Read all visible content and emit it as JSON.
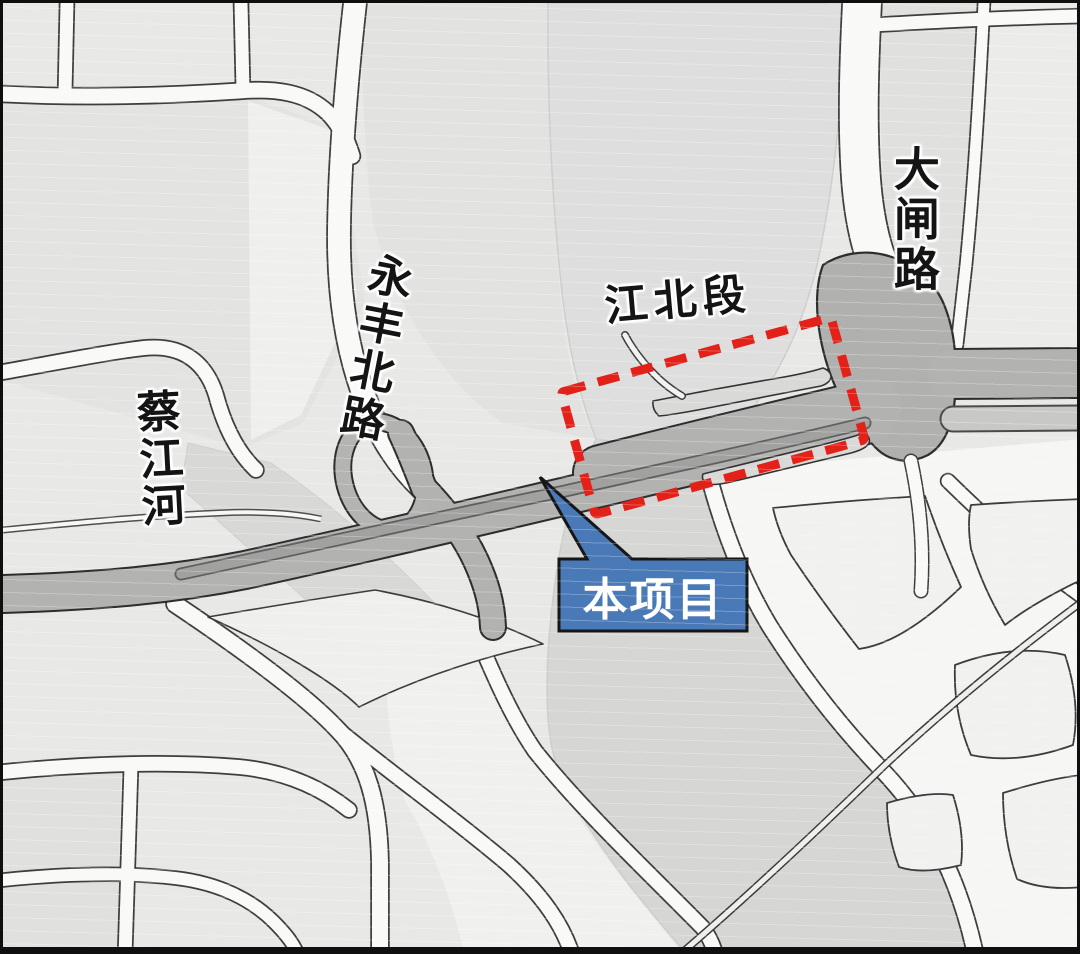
{
  "map": {
    "type": "project-location-map",
    "background_color": "#e8e8e7",
    "frame_color": "#0f0f0f",
    "road_colors": {
      "local_road_fill": "#f9f9f8",
      "road_outline": "#3e3e3e",
      "arterial_fill": "#b2b2b1",
      "arterial_median": "#a1a1a0",
      "junction_fill": "#b0b0af",
      "river_corridor": "#d6d6d5"
    }
  },
  "labels": {
    "caijiang_river": {
      "text": "蔡江河",
      "orientation": "vertical"
    },
    "yongfeng_north_road": {
      "text": "永丰北路",
      "orientation": "vertical"
    },
    "jiangbei_section": {
      "text": "江北段",
      "orientation": "horizontal"
    },
    "dazha_road": {
      "text": "大闸路",
      "orientation": "vertical"
    }
  },
  "highlight": {
    "style": "dashed-rectangle",
    "stroke_color": "#e32119"
  },
  "callout": {
    "text": "本项目",
    "fill_color": "#4a79b7",
    "border_color": "#161616",
    "text_color": "#ffffff"
  }
}
